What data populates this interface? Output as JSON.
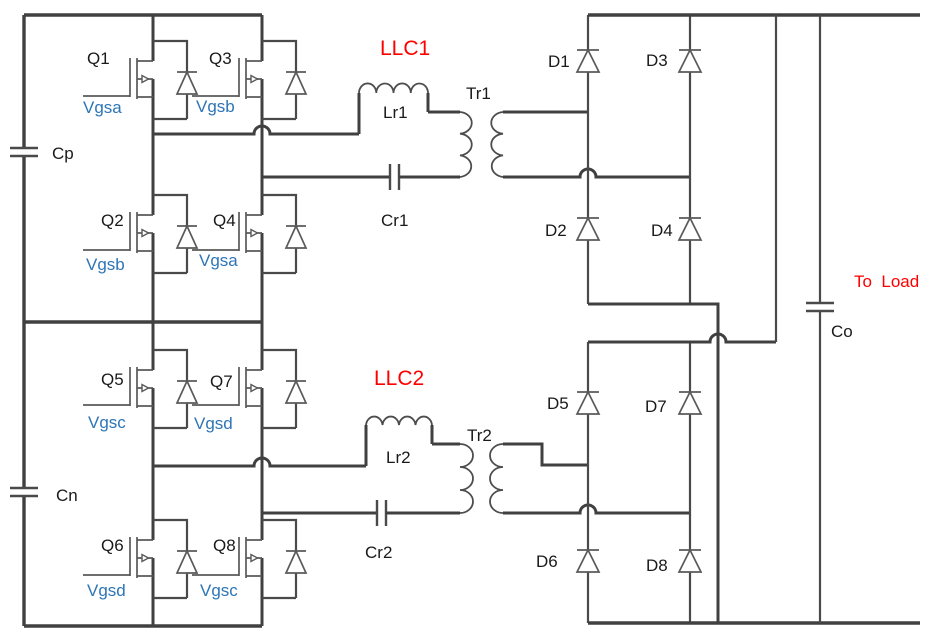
{
  "colors": {
    "background": "#FFFFFF",
    "wire": "#404040",
    "component_stroke": "#595959",
    "label_text": "#1A1A1A",
    "gate_label_blue": "#2E75B6",
    "highlight_red": "#FF0000"
  },
  "schematic": {
    "llc1": {
      "title": "LLC1",
      "q1": {
        "name": "Q1",
        "gate": "Vgsa"
      },
      "q2": {
        "name": "Q2",
        "gate": "Vgsb"
      },
      "q3": {
        "name": "Q3",
        "gate": "Vgsb"
      },
      "q4": {
        "name": "Q4",
        "gate": "Vgsa"
      },
      "inductor": "Lr1",
      "resonant_cap": "Cr1",
      "transformer": "Tr1",
      "diodes": {
        "d1": "D1",
        "d2": "D2",
        "d3": "D3",
        "d4": "D4"
      }
    },
    "llc2": {
      "title": "LLC2",
      "q5": {
        "name": "Q5",
        "gate": "Vgsc"
      },
      "q6": {
        "name": "Q6",
        "gate": "Vgsd"
      },
      "q7": {
        "name": "Q7",
        "gate": "Vgsd"
      },
      "q8": {
        "name": "Q8",
        "gate": "Vgsc"
      },
      "inductor": "Lr2",
      "resonant_cap": "Cr2",
      "transformer": "Tr2",
      "diodes": {
        "d5": "D5",
        "d6": "D6",
        "d7": "D7",
        "d8": "D8"
      }
    },
    "input": {
      "cap_positive": "Cp",
      "cap_negative": "Cn"
    },
    "output": {
      "cap": "Co",
      "load_label": "To  Load"
    }
  }
}
